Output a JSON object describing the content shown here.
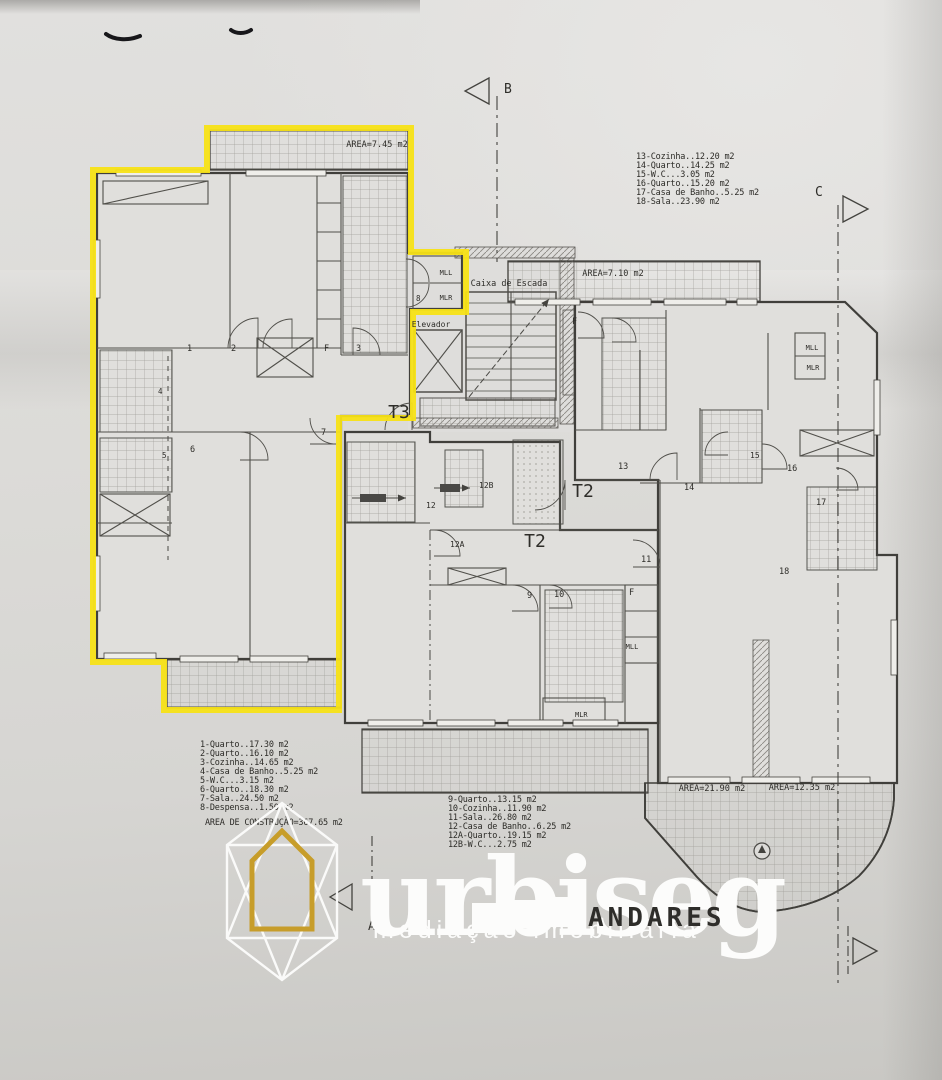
{
  "watermark": {
    "brand": "urbiseg",
    "tagline": "mediação imobiliária",
    "colors": {
      "white": "#fcfcfb",
      "gold": "#c79d2a"
    }
  },
  "plan": {
    "title": "ANDARES",
    "highlight_color": "#f7e216",
    "legend_t3": {
      "lines": [
        "1-Quarto..17.30 m2",
        "2-Quarto..16.10 m2",
        "3-Cozinha..14.65 m2",
        "4-Casa de Banho..5.25 m2",
        "5-W.C...3.15 m2",
        "6-Quarto..18.30 m2",
        "7-Sala..24.50 m2",
        "8-Despensa..1.50 m2"
      ],
      "total": "AREA DE CONSTRUÇÃO=367.65 m2"
    },
    "legend_t2_bottom": {
      "lines": [
        "9-Quarto..13.15 m2",
        "10-Cozinha..11.90 m2",
        "11-Sala..26.80 m2",
        "12-Casa de Banho..6.25 m2",
        "12A-Quarto..19.15 m2",
        "12B-W.C...2.75 m2"
      ]
    },
    "legend_t2_right": {
      "lines": [
        "13-Cozinha..12.20 m2",
        "14-Quarto..14.25 m2",
        "15-W.C...3.05 m2",
        "16-Quarto..15.20 m2",
        "17-Casa de Banho..5.25 m2",
        "18-Sala..23.90 m2"
      ]
    },
    "labels": [
      {
        "n": "area-label-745",
        "t": "AREA=7.45 m2",
        "x": 377,
        "y": 147,
        "s": 8.5,
        "a": "middle"
      },
      {
        "n": "area-label-710",
        "t": "AREA=7.10 m2",
        "x": 613,
        "y": 276,
        "s": 8.5,
        "a": "middle"
      },
      {
        "n": "area-label-2190",
        "t": "AREA=21.90 m2",
        "x": 712,
        "y": 791,
        "s": 8.5,
        "a": "middle"
      },
      {
        "n": "area-label-1235",
        "t": "AREA=12.35 m2",
        "x": 802,
        "y": 790,
        "s": 8.5,
        "a": "middle"
      },
      {
        "n": "caixa-de-escada-label",
        "t": "Caixa de Escada",
        "x": 509,
        "y": 286,
        "s": 8.5,
        "a": "middle"
      },
      {
        "n": "elevador-label",
        "t": "Elevador",
        "x": 431,
        "y": 327,
        "s": 8,
        "a": "middle"
      },
      {
        "n": "unit-label-t3",
        "t": "T3",
        "x": 399,
        "y": 418,
        "s": 18,
        "a": "middle"
      },
      {
        "n": "unit-label-t2-right",
        "t": "T2",
        "x": 583,
        "y": 497,
        "s": 18,
        "a": "middle"
      },
      {
        "n": "unit-label-t2-bottom",
        "t": "T2",
        "x": 535,
        "y": 547,
        "s": 18,
        "a": "middle"
      },
      {
        "n": "room-label-1",
        "t": "1",
        "x": 187,
        "y": 351,
        "s": 8.5
      },
      {
        "n": "room-label-2",
        "t": "2",
        "x": 231,
        "y": 351,
        "s": 8.5
      },
      {
        "n": "room-label-f-t3",
        "t": "F",
        "x": 324,
        "y": 351,
        "s": 8.5
      },
      {
        "n": "room-label-3",
        "t": "3",
        "x": 356,
        "y": 351,
        "s": 8.5
      },
      {
        "n": "room-label-4",
        "t": "4",
        "x": 158,
        "y": 394,
        "s": 7.5
      },
      {
        "n": "room-label-5",
        "t": "5",
        "x": 162,
        "y": 458,
        "s": 7.5
      },
      {
        "n": "room-label-6",
        "t": "6",
        "x": 190,
        "y": 452,
        "s": 8.5
      },
      {
        "n": "room-label-7",
        "t": "7",
        "x": 321,
        "y": 435,
        "s": 8.5
      },
      {
        "n": "room-label-8",
        "t": "8",
        "x": 416,
        "y": 301,
        "s": 7.5
      },
      {
        "n": "closet-label-mll-core",
        "t": "MLL",
        "x": 446,
        "y": 275,
        "s": 7,
        "a": "middle"
      },
      {
        "n": "closet-label-mlr-core",
        "t": "MLR",
        "x": 446,
        "y": 300,
        "s": 7,
        "a": "middle"
      },
      {
        "n": "room-label-9",
        "t": "9",
        "x": 527,
        "y": 598,
        "s": 8.5
      },
      {
        "n": "room-label-10",
        "t": "10",
        "x": 554,
        "y": 597,
        "s": 8.5
      },
      {
        "n": "room-label-f-bottom",
        "t": "F",
        "x": 629,
        "y": 595,
        "s": 8.5
      },
      {
        "n": "closet-label-mll-bottom",
        "t": "MLL",
        "x": 632,
        "y": 649,
        "s": 7,
        "a": "middle"
      },
      {
        "n": "closet-label-mlr-bottom",
        "t": "MLR",
        "x": 575,
        "y": 717,
        "s": 7
      },
      {
        "n": "room-label-11",
        "t": "11",
        "x": 641,
        "y": 562,
        "s": 8.5
      },
      {
        "n": "room-label-12",
        "t": "12",
        "x": 426,
        "y": 508,
        "s": 8
      },
      {
        "n": "room-label-12a",
        "t": "12A",
        "x": 450,
        "y": 547,
        "s": 8
      },
      {
        "n": "room-label-12b",
        "t": "12B",
        "x": 479,
        "y": 488,
        "s": 8
      },
      {
        "n": "room-label-13",
        "t": "13",
        "x": 618,
        "y": 469,
        "s": 8.5
      },
      {
        "n": "room-label-14",
        "t": "14",
        "x": 684,
        "y": 490,
        "s": 8.5
      },
      {
        "n": "room-label-15",
        "t": "15",
        "x": 750,
        "y": 458,
        "s": 8
      },
      {
        "n": "room-label-16",
        "t": "16",
        "x": 787,
        "y": 471,
        "s": 8.5
      },
      {
        "n": "room-label-17",
        "t": "17",
        "x": 816,
        "y": 505,
        "s": 8.5
      },
      {
        "n": "room-label-18",
        "t": "18",
        "x": 779,
        "y": 574,
        "s": 8.5
      },
      {
        "n": "room-label-f-right",
        "t": "F",
        "x": 572,
        "y": 324,
        "s": 8.5
      },
      {
        "n": "closet-label-mll-right",
        "t": "MLL",
        "x": 812,
        "y": 350,
        "s": 7,
        "a": "middle"
      },
      {
        "n": "closet-label-mlr-right",
        "t": "MLR",
        "x": 813,
        "y": 370,
        "s": 7,
        "a": "middle"
      },
      {
        "n": "section-marker-b-label",
        "t": "B",
        "x": 504,
        "y": 93,
        "s": 13
      },
      {
        "n": "section-marker-c-label",
        "t": "C",
        "x": 815,
        "y": 196,
        "s": 13
      },
      {
        "n": "section-marker-a-label",
        "t": "A",
        "x": 368,
        "y": 930,
        "s": 12
      }
    ]
  }
}
